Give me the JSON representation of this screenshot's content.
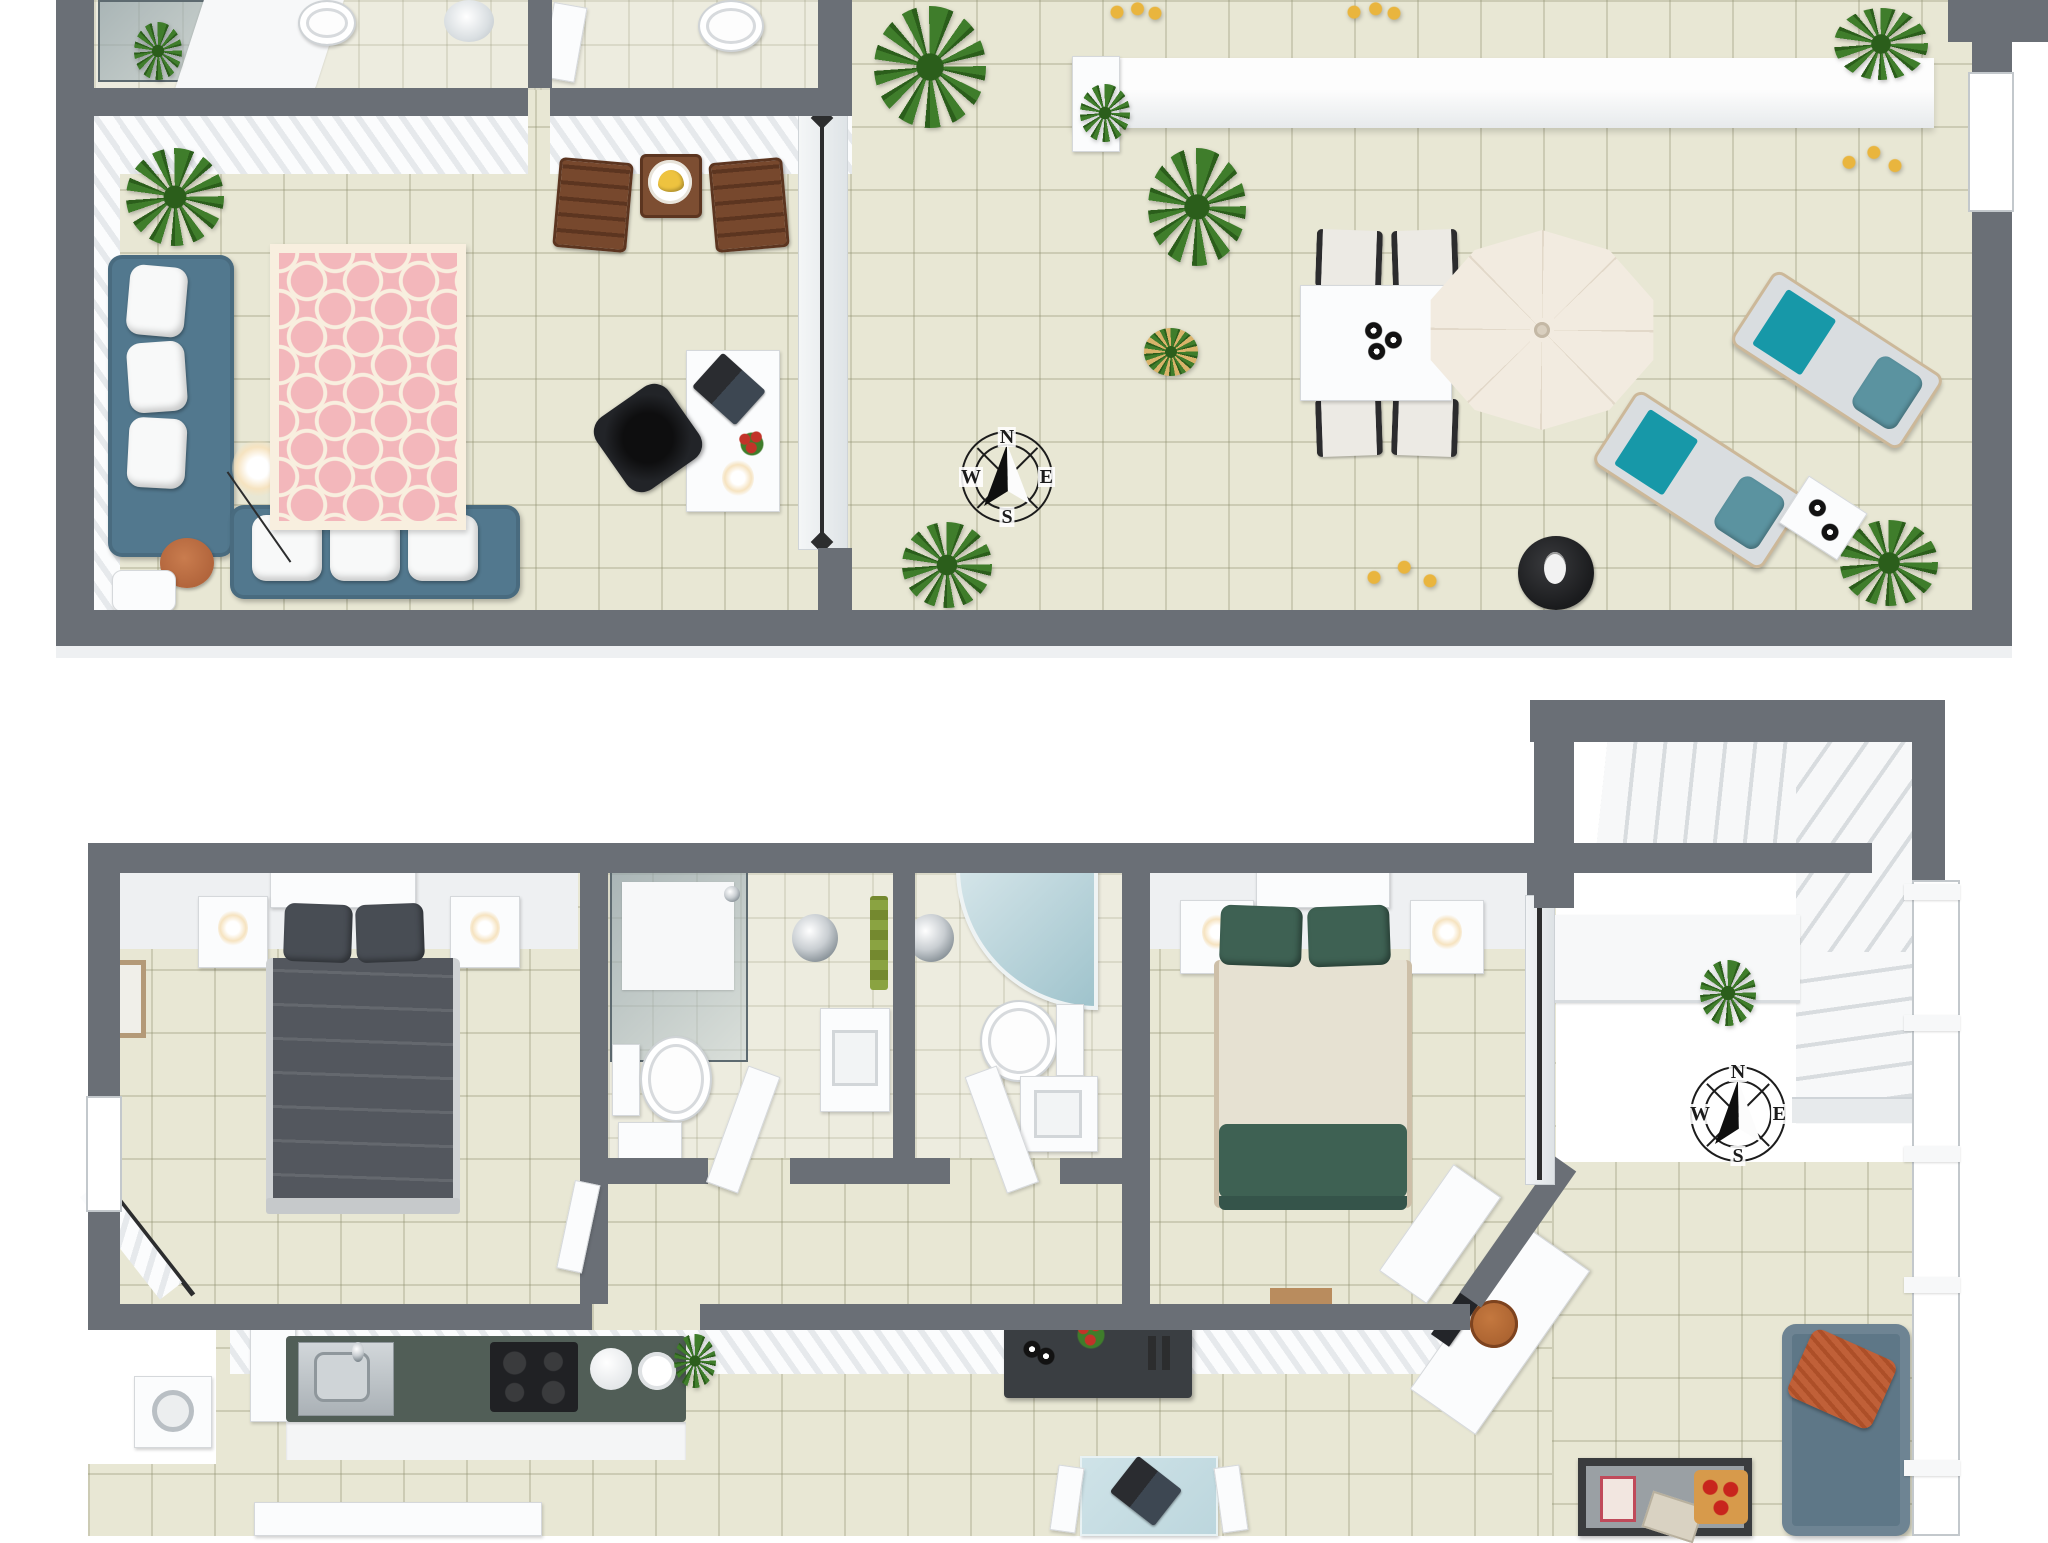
{
  "compass": {
    "n": "N",
    "e": "E",
    "s": "S",
    "w": "W"
  },
  "colors": {
    "background": "#ffffff",
    "wall": "#6a6f76",
    "wall_face": "#eef0f2",
    "floor_tile": "#e8e7d4",
    "bath_tile": "#edecdf",
    "plant_green": "#3f7d2b",
    "plant_dark": "#2b5e1b",
    "lemon_yellow": "#e9b53e",
    "sofa_blue": "#52788e",
    "cushion_white": "#f8f9f9",
    "rug_pink": "#f3b7bb",
    "rug_cream": "#f8efdf",
    "pouf_terracotta": "#b2653c",
    "wood_brown": "#77482d",
    "banana_yellow": "#eec33f",
    "umbrella_cream": "#f2ebe0",
    "lounger_gray": "#d9dde0",
    "lounger_frame": "#ccb899",
    "towel_teal": "#1798a8",
    "pillow_teal": "#5b93a0",
    "grill_black": "#1a1b1d",
    "bed1_dark": "#53575e",
    "bed1_pillow": "#484d54",
    "bed2_green": "#3e6153",
    "bed2_cream": "#e6e1d2",
    "towel_green": "#8aa341",
    "kitchen_counter": "#515e57",
    "steel_gray": "#c0c6ca",
    "cooktop_black": "#202124",
    "dark_furniture": "#3a3e42",
    "sofa2_blue": "#5e7787",
    "pillow_orange": "#c06038",
    "glass_teal": "#bcd6dd",
    "wood_light": "#a9612f",
    "compass_ink": "#1c1c1c",
    "curtain_rod": "#2c2d2e",
    "wall_face_stripe": "#e6e9ec"
  }
}
